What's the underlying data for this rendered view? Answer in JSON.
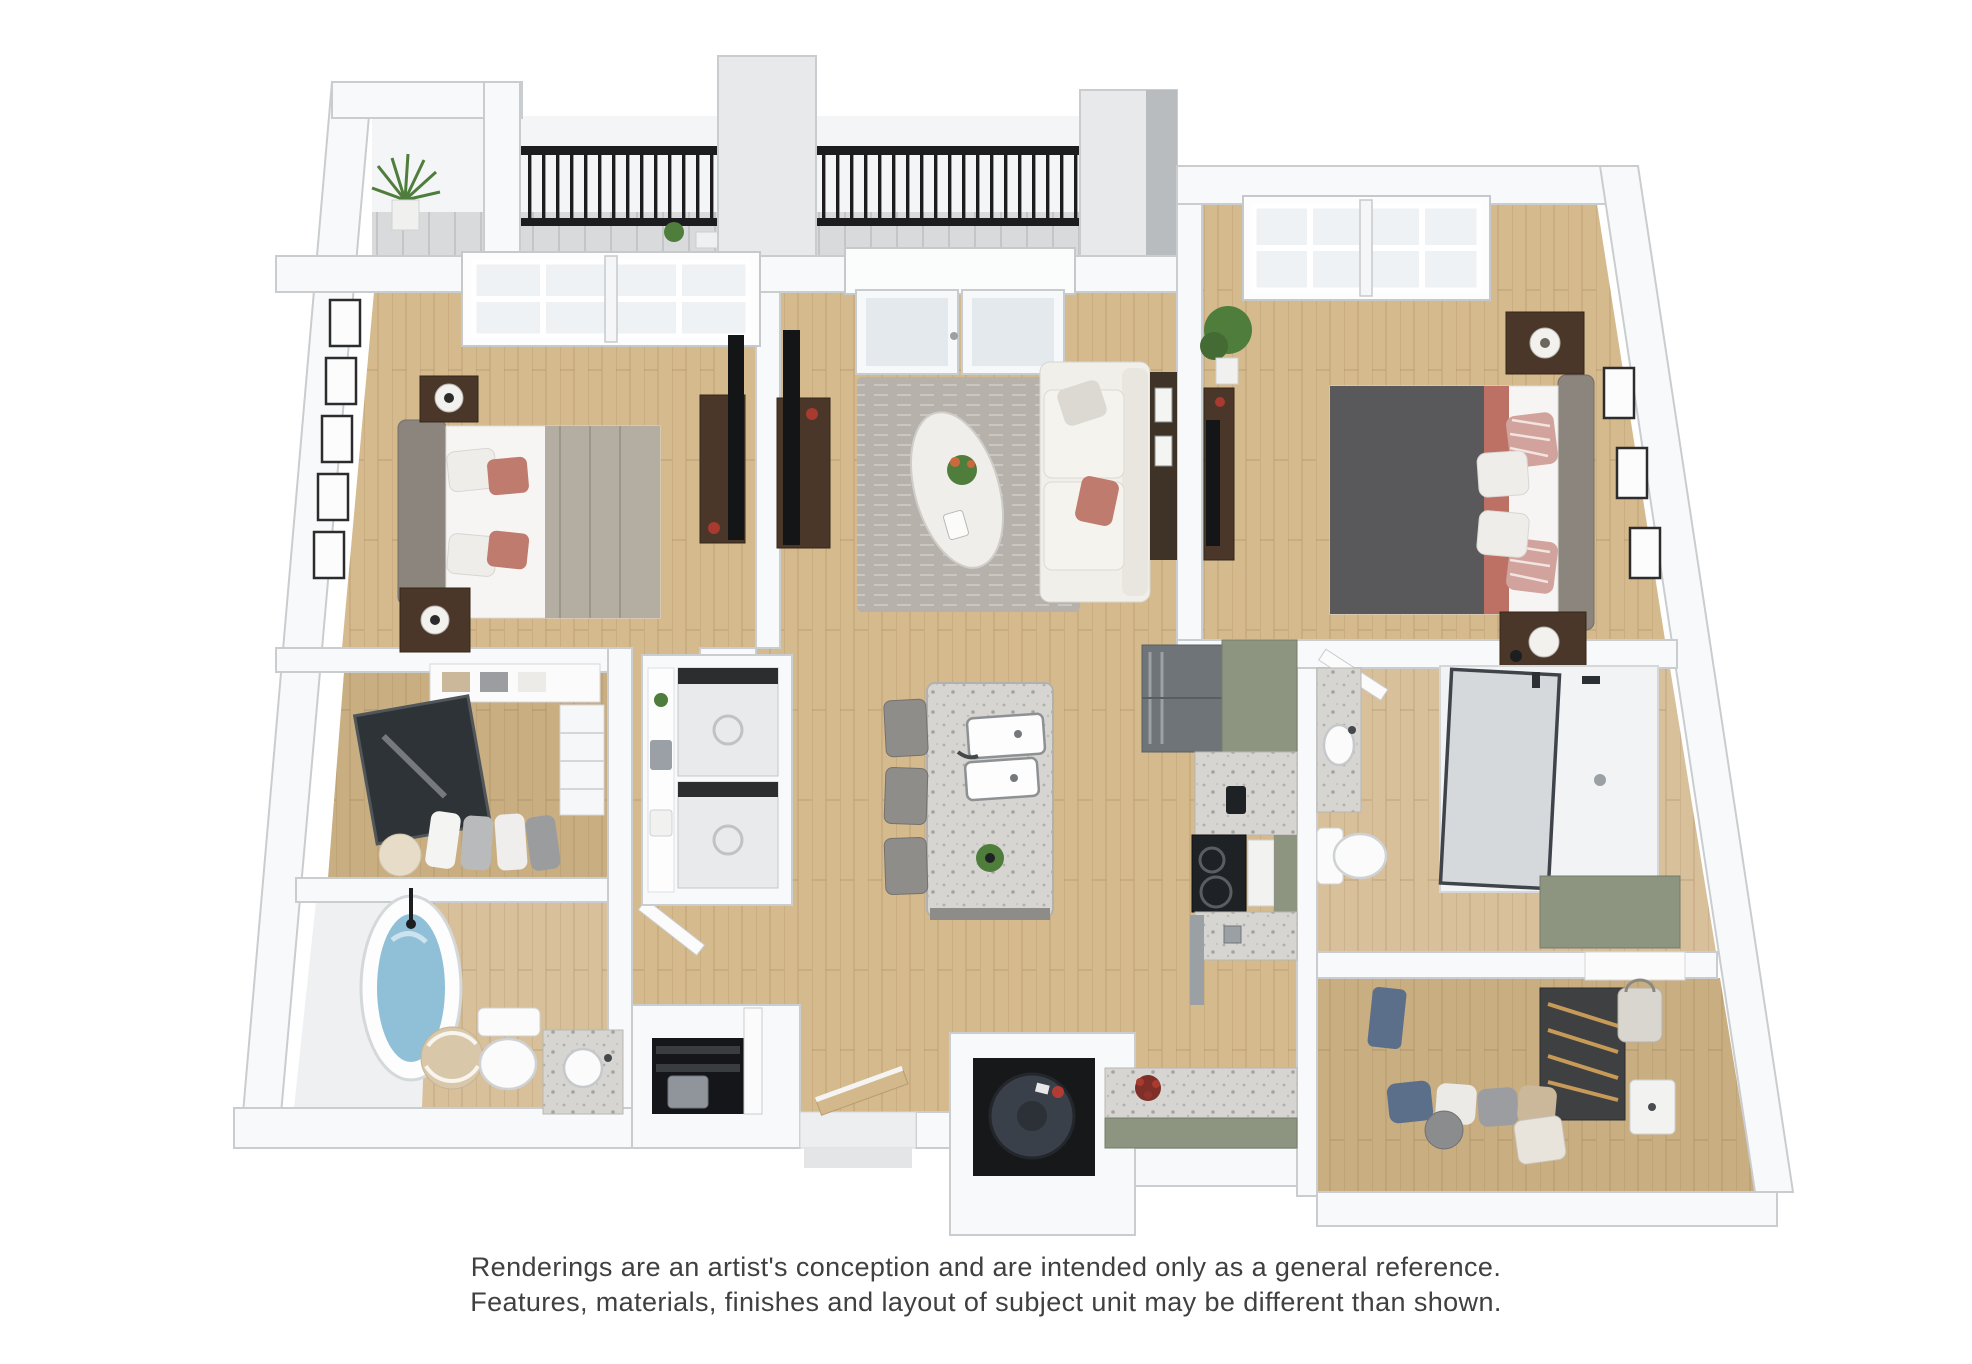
{
  "page": {
    "background": "#ffffff"
  },
  "disclaimer": {
    "line1": "Renderings are an artist's conception and are intended only as a general reference.",
    "line2": "Features, materials, finishes and layout of subject unit may be different than shown.",
    "text_color": "#404040"
  },
  "floor_plan": {
    "type": "3d-top-down-apartment-rendering",
    "rooms": [
      "balcony",
      "bedroom-1",
      "living-room",
      "bedroom-2",
      "walk-in-closet-1",
      "laundry-closet",
      "bathroom-1",
      "entry-closet",
      "kitchen",
      "kitchen-island",
      "bathroom-2",
      "walk-in-closet-2",
      "utility-closet"
    ],
    "palette": {
      "wood": "#d5ba8e",
      "wood_dark": "#c9ae82",
      "wood_light": "#d8c09a",
      "wall": "#f8f9fa",
      "wall_line": "#c9cdd0",
      "railing": "#1d1d1f",
      "concrete": "#d9dadb",
      "rug": "#b6b1ab",
      "sofa": "#f1efe9",
      "granite": "#d7d5d1",
      "sage": "#8d9480",
      "stainless": "#9ba0a4",
      "stainless_dark": "#6f7478",
      "cooktop": "#1f2224",
      "water": "#8fc0d8",
      "duvet": "#59595b",
      "coral": "#bd7164",
      "rose": "#bf7b6d",
      "linen": "#f6f5f3",
      "headboard": "#8b857e",
      "brown": "#4a3729",
      "tv": "#141517",
      "plant": "#4f7d3c",
      "heater": "#3a4049",
      "mirror": "#2e3337",
      "basket": "#d9c7a9",
      "denim": "#5b6f8a"
    }
  }
}
